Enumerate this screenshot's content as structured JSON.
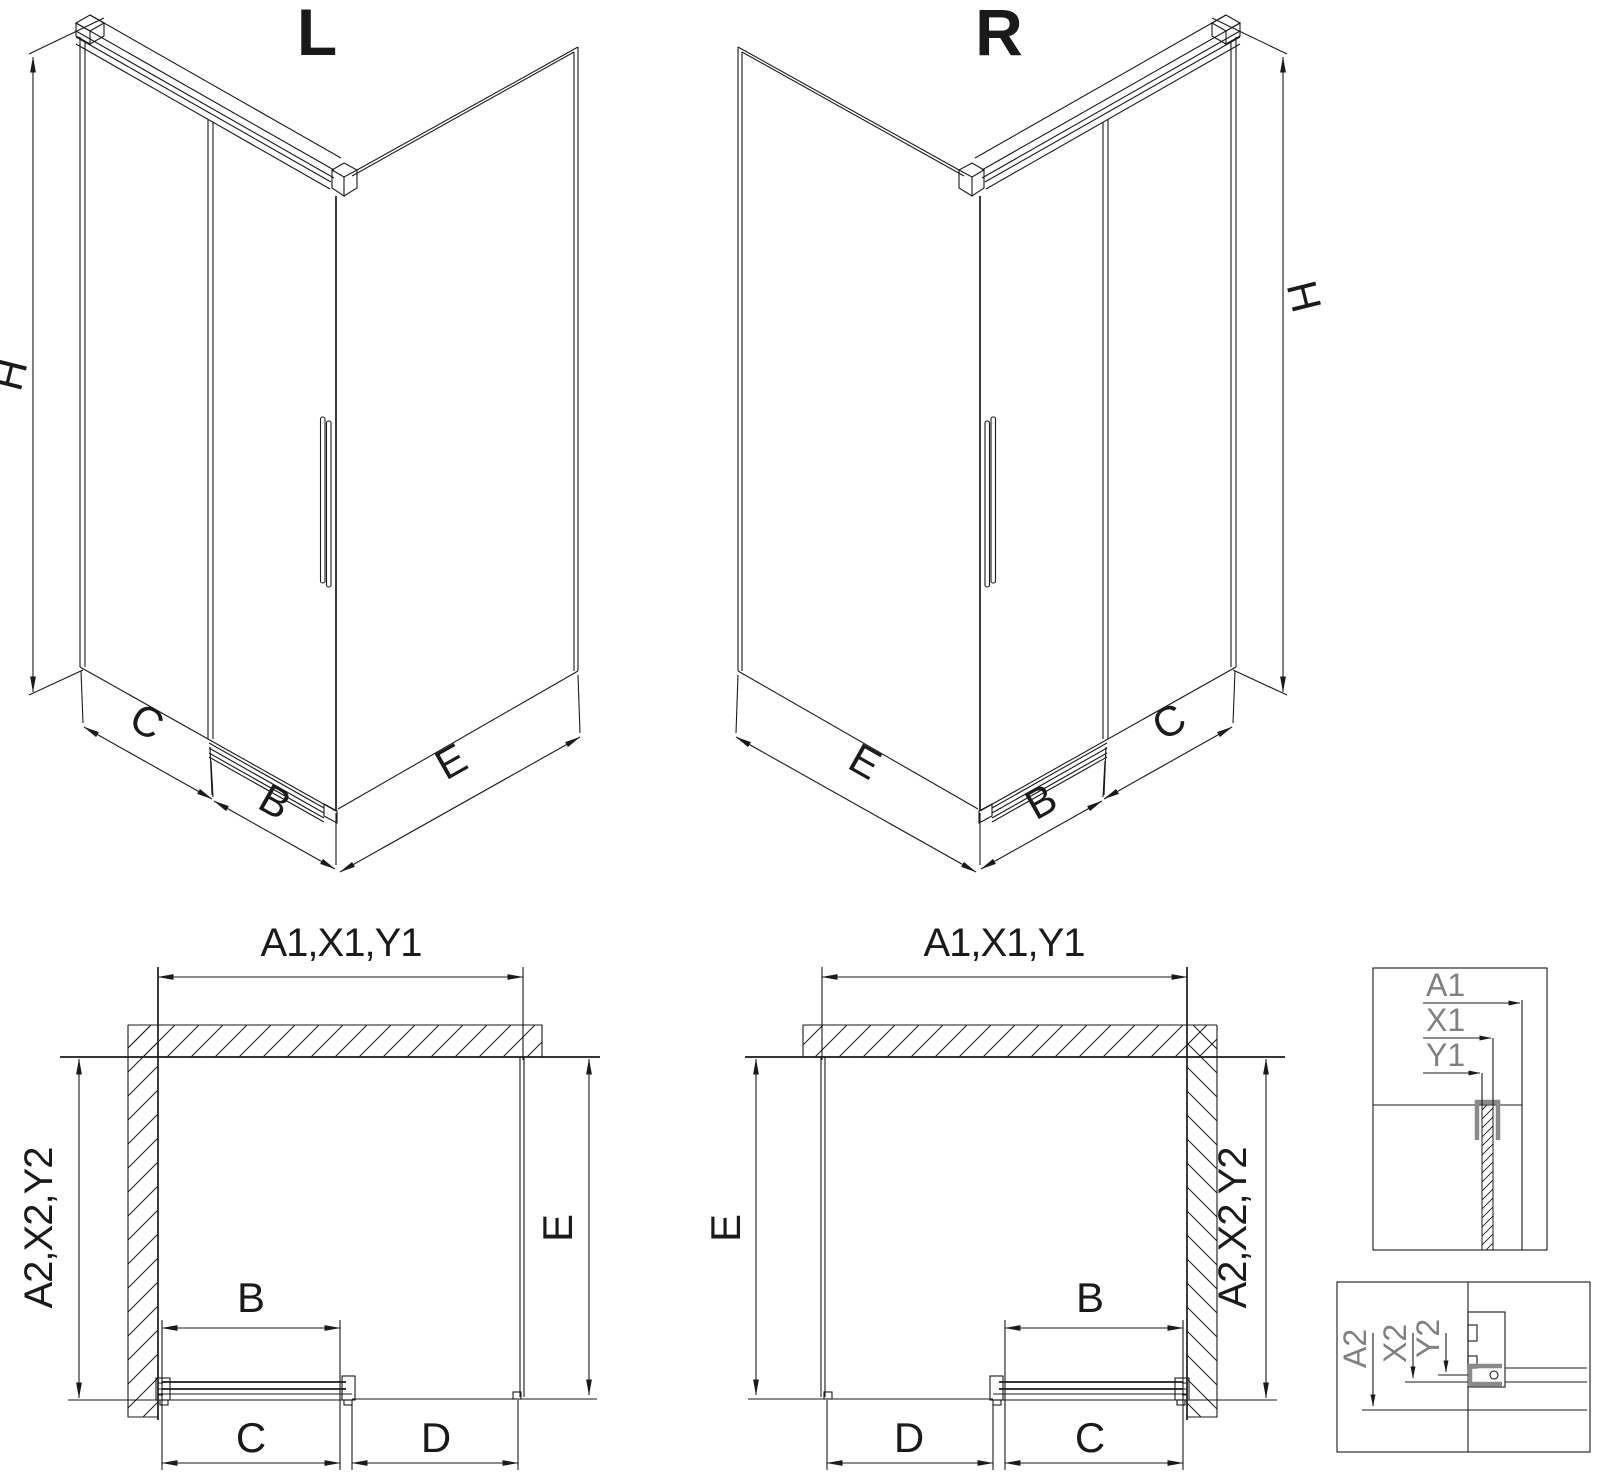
{
  "views": {
    "iso_left": {
      "title": "L",
      "dim_height": "H",
      "dim_fixed": "C",
      "dim_door": "B",
      "dim_side": "E"
    },
    "iso_right": {
      "title": "R",
      "dim_height": "H",
      "dim_fixed": "C",
      "dim_door": "B",
      "dim_side": "E"
    },
    "plan_left": {
      "dim_width": "A1,X1,Y1",
      "dim_depth": "A2,X2,Y2",
      "dim_door": "B",
      "dim_fixed": "C",
      "dim_opening": "D",
      "dim_side": "E"
    },
    "plan_right": {
      "dim_width": "A1,X1,Y1",
      "dim_depth": "A2,X2,Y2",
      "dim_door": "B",
      "dim_fixed": "C",
      "dim_opening": "D",
      "dim_side": "E"
    },
    "detail_top": {
      "a1": "A1",
      "x1": "X1",
      "y1": "Y1"
    },
    "detail_bottom": {
      "a2": "A2",
      "x2": "X2",
      "y2": "Y2"
    }
  },
  "colors": {
    "line": "#1a1a1a",
    "profile_gray": "#8a8a8a"
  }
}
